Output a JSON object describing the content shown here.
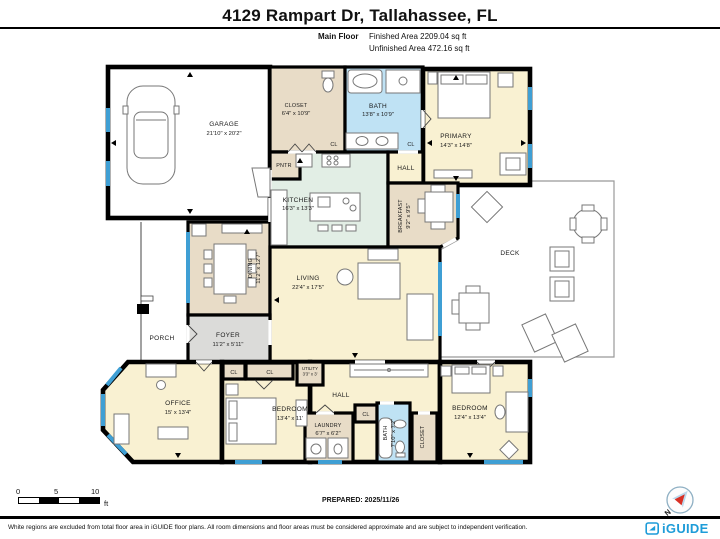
{
  "header": {
    "title": "4129 Rampart Dr, Tallahassee, FL",
    "floor_label": "Main Floor",
    "finished_area": "Finished Area 2209.04 sq ft",
    "unfinished_area": "Unfinished Area 472.16 sq ft"
  },
  "rooms": {
    "garage": {
      "name": "GARAGE",
      "dims": "21'10\" x 20'2\""
    },
    "closet_top": {
      "name": "CLOSET",
      "dims": "6'4\" x 10'9\""
    },
    "bath_top": {
      "name": "BATH",
      "dims": "13'8\" x 10'9\""
    },
    "primary": {
      "name": "PRIMARY",
      "dims": "14'3\" x 14'8\""
    },
    "pantry": {
      "name": "PNTR"
    },
    "hall_top": {
      "name": "HALL"
    },
    "kitchen": {
      "name": "KITCHEN",
      "dims": "16'3\" x 13'3\""
    },
    "breakfast": {
      "name": "BREAKFAST",
      "dims": "9'2\" x 9'5\""
    },
    "deck": {
      "name": "DECK"
    },
    "dining": {
      "name": "DINING",
      "dims": "11'2\" x 12'7\""
    },
    "living": {
      "name": "LIVING",
      "dims": "22'4\" x 17'5\""
    },
    "porch": {
      "name": "PORCH"
    },
    "foyer": {
      "name": "FOYER",
      "dims": "11'2\" x 5'11\""
    },
    "office": {
      "name": "OFFICE",
      "dims": "15' x 13'4\""
    },
    "bedroom_left": {
      "name": "BEDROOM",
      "dims": "13'4\" x 11'"
    },
    "utility": {
      "name": "UTILITY",
      "dims": "3'3\" x 3'"
    },
    "hall_bottom": {
      "name": "HALL"
    },
    "laundry": {
      "name": "LAUNDRY",
      "dims": "6'7\" x 6'2\""
    },
    "bath_bottom": {
      "name": "BATH",
      "dims": "7'10\" x 7'2\""
    },
    "closet_bottom": {
      "name": "CLOSET"
    },
    "bedroom_right": {
      "name": "BEDROOM",
      "dims": "12'4\" x 13'4\""
    },
    "closet_small": {
      "name": "CL"
    }
  },
  "footer": {
    "scale": {
      "tick0": "0",
      "tick5": "5",
      "tick10": "10",
      "unit": "ft"
    },
    "prepared": "PREPARED: 2025/11/26",
    "compass_north": "N",
    "disclaimer": "White regions are excluded from total floor area in iGUIDE floor plans. All room dimensions and floor areas must be considered approximate and are subject to independent verification.",
    "brand": "iGUIDE"
  },
  "colors": {
    "wall": "#000000",
    "window_blue": "#3f9fd4",
    "floor_cream": "#f9f1d2",
    "floor_tan": "#e8dcc7",
    "floor_blue": "#bfe2f4",
    "floor_green": "#e2eee5",
    "floor_gray": "#dbdbd9",
    "deck_outline": "#999999",
    "brand_blue": "#1e9cd8",
    "compass_red": "#d93025"
  }
}
